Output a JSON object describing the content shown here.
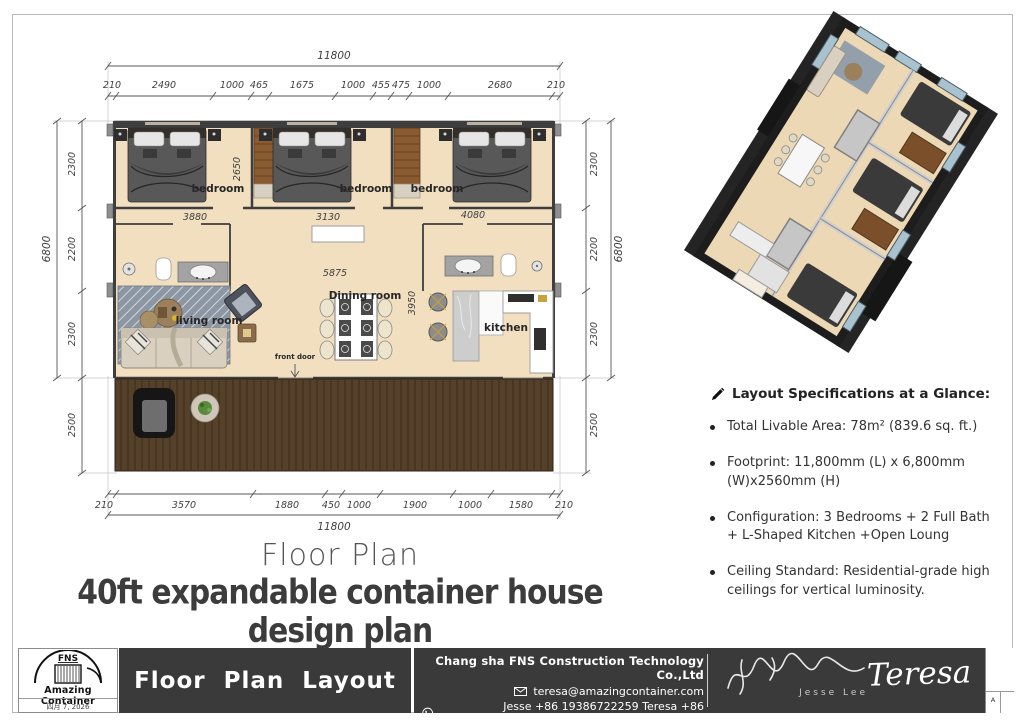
{
  "plan": {
    "top_total": "11800",
    "top_segments": [
      "210",
      "2490",
      "1000",
      "465",
      "1675",
      "1000",
      "455",
      "475",
      "1000",
      "2680",
      "210"
    ],
    "bottom_segments": [
      "210",
      "3570",
      "1880",
      "450",
      "1000",
      "1900",
      "1000",
      "1580",
      "210"
    ],
    "bottom_total": "11800",
    "left_segments": [
      "2300",
      "2200",
      "2300",
      "2500"
    ],
    "left_total": "6800",
    "right_segments": [
      "2300",
      "2200",
      "2300",
      "2500"
    ],
    "right_total": "6800",
    "interior_dims": {
      "bedroom1_depth": "2650",
      "bath_left_width": "3880",
      "hall_mid_width": "3130",
      "bath_right_width": "4080",
      "living_span": "5875",
      "dining_depth": "3950"
    },
    "rooms": {
      "bedroom1": "bedroom",
      "bedroom2": "bedroom",
      "bedroom3": "bedroom",
      "living": "living room",
      "dining": "Dining room",
      "kitchen": "kitchen",
      "front_door": "front door"
    }
  },
  "titles": {
    "subtitle": "Floor Plan",
    "main": "40ft expandable container house design plan"
  },
  "specs": {
    "header": "Layout Specifications at a Glance:",
    "items": [
      "Total Livable Area: 78m² (839.6 sq. ft.)",
      "Footprint: 11,800mm (L) x 6,800mm (W)x2560mm  (H)",
      "Configuration: 3 Bedrooms + 2 Full Bath + L-Shaped Kitchen +Open Loung",
      "Ceiling Standard: Residential-grade high ceilings for vertical luminosity."
    ]
  },
  "footer": {
    "logo_top": "FNS",
    "logo_name": "Amazing Container",
    "date": "四月 7, 2026",
    "sheet_title": "Floor Plan Layout",
    "company": "Chang sha FNS Construction Technology Co.,Ltd",
    "email": "teresa@amazingcontainer.com",
    "phones": "Jesse +86 19386722259   Teresa  +86 18559296949",
    "website": "https://www.amazingcontainer.com",
    "signature_jesse": "Jesse Lee",
    "signature_teresa": "Teresa",
    "revision": "A"
  },
  "colors": {
    "floor": "#f1dfc0",
    "wall": "#3e3e3e",
    "wardrobe": "#8a5a30",
    "deck": "#55402a",
    "footer_dark": "#3a3a3a"
  }
}
